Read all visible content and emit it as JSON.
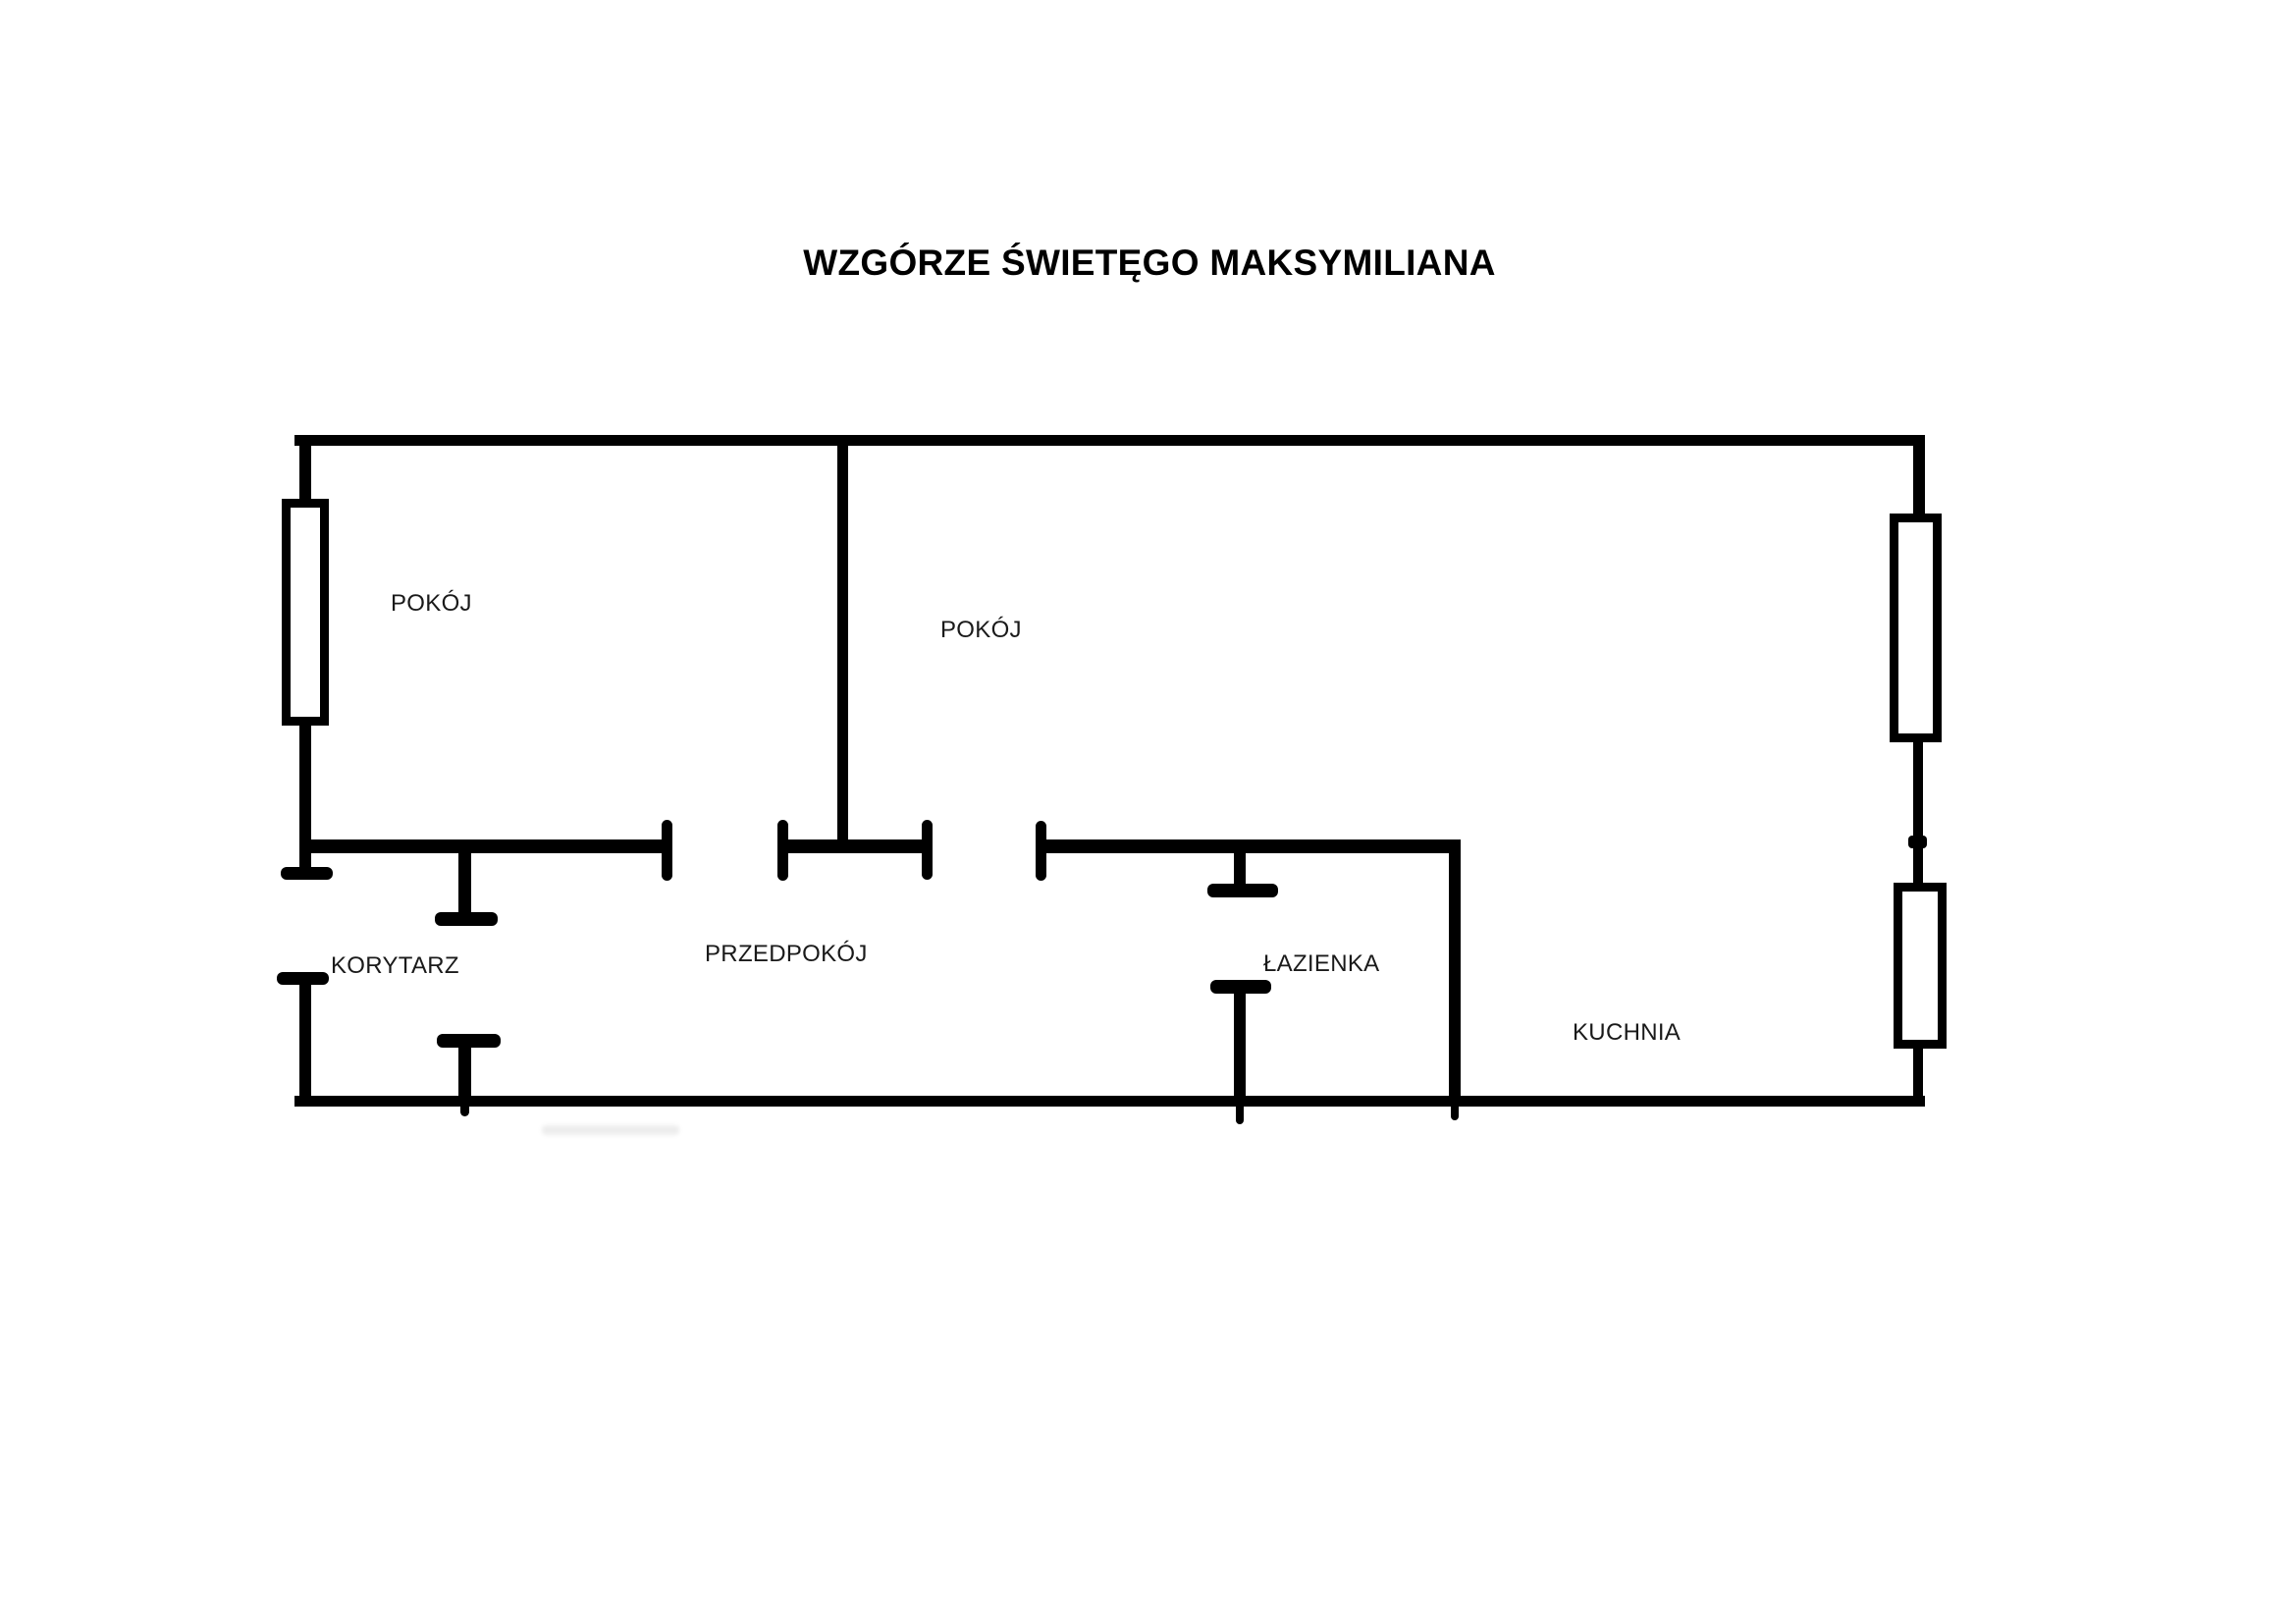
{
  "title": "WZGÓRZE ŚWIETĘGO MAKSYMILIANA",
  "rooms": {
    "pokoj_left": {
      "label": "POKÓJ"
    },
    "pokoj_right": {
      "label": "POKÓJ"
    },
    "korytarz": {
      "label": "KORYTARZ"
    },
    "przedpokoj": {
      "label": "PRZEDPOKÓJ"
    },
    "lazienka": {
      "label": "ŁAZIENKA"
    },
    "kuchnia": {
      "label": "KUCHNIA"
    }
  },
  "colors": {
    "wall": "#000000",
    "label_text": "#1a1a1a",
    "background": "#ffffff"
  }
}
